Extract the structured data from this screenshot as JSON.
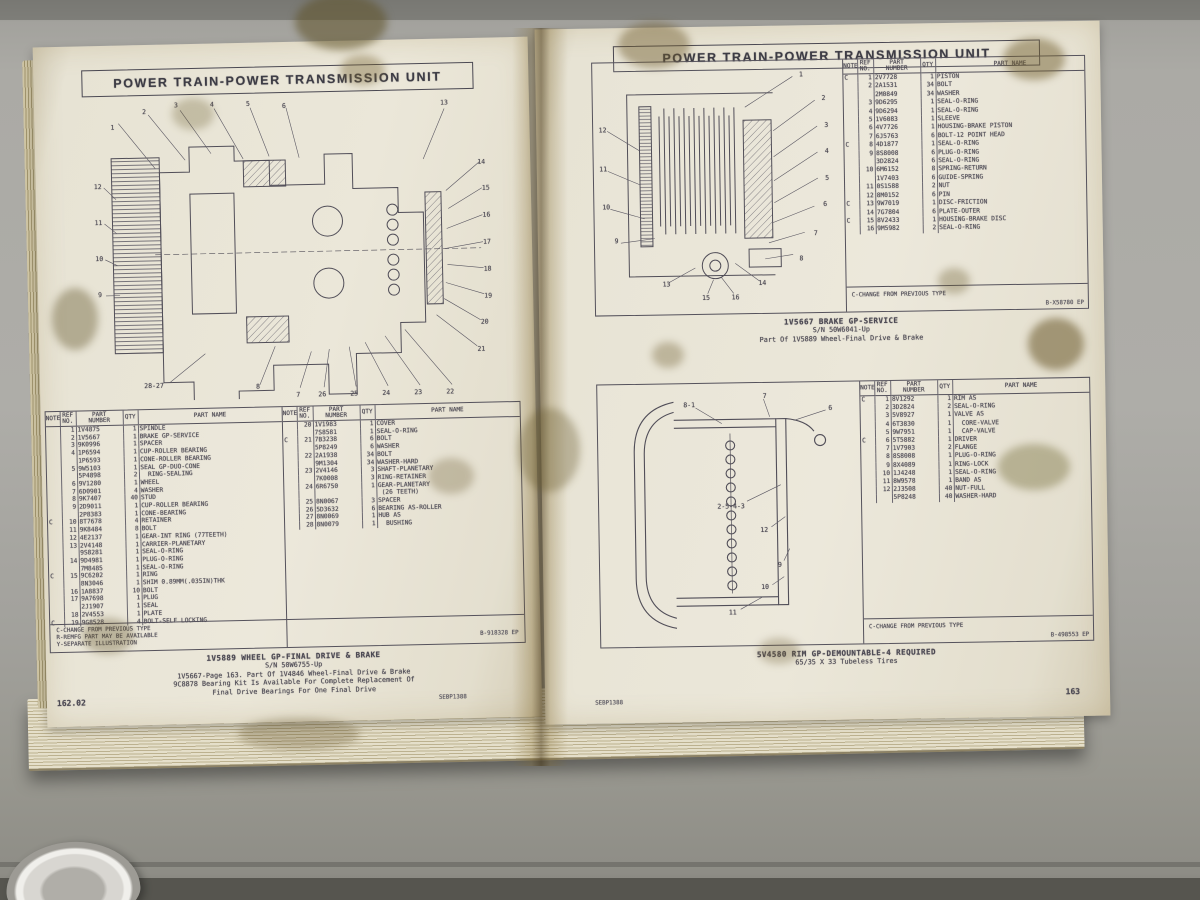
{
  "page_header": "POWER TRAIN-POWER TRANSMISSION UNIT",
  "table_headers": [
    "NOTE",
    "REF\nNO.",
    "PART\nNUMBER",
    "QTY",
    "PART NAME"
  ],
  "left_page": {
    "header": "POWER TRAIN-POWER TRANSMISSION UNIT",
    "parts_left": [
      [
        "",
        "1",
        "1V4875",
        "1",
        "SPINDLE"
      ],
      [
        "",
        "2",
        "1V5667",
        "1",
        "BRAKE GP-SERVICE"
      ],
      [
        "",
        "3",
        "9K0996",
        "1",
        "SPACER"
      ],
      [
        "",
        "4",
        "1P6594",
        "1",
        "CUP-ROLLER BEARING"
      ],
      [
        "",
        "",
        "1P6593",
        "1",
        "CONE-ROLLER BEARING"
      ],
      [
        "",
        "5",
        "9W5103",
        "1",
        "SEAL GP-DUO-CONE"
      ],
      [
        "",
        "",
        "5P4898",
        "2",
        "  RING-SEALING"
      ],
      [
        "",
        "6",
        "9V1280",
        "1",
        "WHEEL"
      ],
      [
        "",
        "7",
        "6D0901",
        "4",
        "WASHER"
      ],
      [
        "",
        "8",
        "9K7407",
        "40",
        "STUD"
      ],
      [
        "",
        "9",
        "2D9011",
        "1",
        "CUP-ROLLER BEARING"
      ],
      [
        "",
        "",
        "2P8383",
        "1",
        "CONE-BEARING"
      ],
      [
        "C",
        "10",
        "8T7678",
        "4",
        "RETAINER"
      ],
      [
        "",
        "11",
        "9K8484",
        "8",
        "BOLT"
      ],
      [
        "",
        "12",
        "4E2137",
        "1",
        "GEAR-INT RING (77TEETH)"
      ],
      [
        "",
        "13",
        "2V4148",
        "1",
        "CARRIER-PLANETARY"
      ],
      [
        "",
        "",
        "9S8281",
        "1",
        "SEAL-O-RING"
      ],
      [
        "",
        "14",
        "9D4981",
        "1",
        "PLUG-O-RING"
      ],
      [
        "",
        "",
        "7M8485",
        "1",
        "SEAL-O-RING"
      ],
      [
        "C",
        "15",
        "9C6202",
        "1",
        "RING"
      ],
      [
        "",
        "",
        "8N3046",
        "1",
        "SHIM 0.89MM(.035IN)THK"
      ],
      [
        "",
        "16",
        "1A8837",
        "10",
        "BOLT"
      ],
      [
        "",
        "17",
        "9A7698",
        "1",
        "PLUG"
      ],
      [
        "",
        "",
        "2J1907",
        "1",
        "SEAL"
      ],
      [
        "",
        "18",
        "2V4553",
        "1",
        "PLATE"
      ],
      [
        "C",
        "19",
        "9G8528",
        "4",
        "BOLT-SELF LOCKING"
      ]
    ],
    "parts_right": [
      [
        "",
        "20",
        "1V1983",
        "1",
        "COVER"
      ],
      [
        "",
        "",
        "7S8581",
        "1",
        "SEAL-O-RING"
      ],
      [
        "C",
        "21",
        "7B3238",
        "6",
        "BOLT"
      ],
      [
        "",
        "",
        "5P8249",
        "6",
        "WASHER"
      ],
      [
        "",
        "22",
        "2A1938",
        "34",
        "BOLT"
      ],
      [
        "",
        "",
        "9M1304",
        "34",
        "WASHER-HARD"
      ],
      [
        "",
        "23",
        "2V4146",
        "3",
        "SHAFT-PLANETARY"
      ],
      [
        "",
        "",
        "7K0008",
        "3",
        "RING-RETAINER"
      ],
      [
        "",
        "24",
        "6R6750",
        "1",
        "GEAR-PLANETARY"
      ],
      [
        "",
        "",
        "",
        "",
        " (26 TEETH)"
      ],
      [
        "",
        "25",
        "8N0067",
        "3",
        "SPACER"
      ],
      [
        "",
        "26",
        "5D3632",
        "6",
        "BEARING AS-ROLLER"
      ],
      [
        "",
        "27",
        "8N0069",
        "1",
        "HUB AS"
      ],
      [
        "",
        "28",
        "8N0079",
        "1",
        "  BUSHING"
      ]
    ],
    "footnotes": "C-CHANGE FROM PREVIOUS TYPE\nR-REMFG PART MAY BE AVAILABLE\nY-SEPARATE ILLUSTRATION",
    "doc_code": "B-918328 EP",
    "caption_title": "1V5889 WHEEL GP-FINAL DRIVE & BRAKE",
    "caption_lines": [
      "S/N 50W6755-Up",
      "1V5667-Page 163. Part Of 1V4846 Wheel-Final Drive & Brake",
      "9C8878 Bearing Kit Is Available For Complete Replacement Of",
      "Final Drive Bearings For One Final Drive"
    ],
    "page_number": "162.02",
    "form_code": "SEBP1388",
    "diagram_callouts": [
      {
        "t": "1",
        "x": 5,
        "y": 8
      },
      {
        "t": "2",
        "x": 13,
        "y": 3
      },
      {
        "t": "3",
        "x": 21,
        "y": 1
      },
      {
        "t": "4",
        "x": 30,
        "y": 1
      },
      {
        "t": "5",
        "x": 39,
        "y": 1
      },
      {
        "t": "6",
        "x": 48,
        "y": 2
      },
      {
        "t": "13",
        "x": 88,
        "y": 2
      },
      {
        "t": "14",
        "x": 97,
        "y": 22
      },
      {
        "t": "15",
        "x": 98,
        "y": 31
      },
      {
        "t": "16",
        "x": 98,
        "y": 40
      },
      {
        "t": "17",
        "x": 98,
        "y": 49
      },
      {
        "t": "18",
        "x": 98,
        "y": 58
      },
      {
        "t": "19",
        "x": 98,
        "y": 67
      },
      {
        "t": "20",
        "x": 97,
        "y": 76
      },
      {
        "t": "21",
        "x": 96,
        "y": 85
      },
      {
        "t": "12",
        "x": 1,
        "y": 28
      },
      {
        "t": "11",
        "x": 1,
        "y": 40
      },
      {
        "t": "10",
        "x": 1,
        "y": 52
      },
      {
        "t": "9",
        "x": 1,
        "y": 64
      },
      {
        "t": "28-27",
        "x": 14,
        "y": 95
      },
      {
        "t": "8",
        "x": 40,
        "y": 96
      },
      {
        "t": "7",
        "x": 50,
        "y": 99
      },
      {
        "t": "26",
        "x": 56,
        "y": 99
      },
      {
        "t": "25",
        "x": 64,
        "y": 99
      },
      {
        "t": "24",
        "x": 72,
        "y": 99
      },
      {
        "t": "23",
        "x": 80,
        "y": 99
      },
      {
        "t": "22",
        "x": 88,
        "y": 99
      }
    ]
  },
  "right_page": {
    "header": "POWER TRAIN-POWER TRANSMISSION UNIT",
    "form_code": "SEBP1388",
    "page_number": "163",
    "brake": {
      "rows": [
        [
          "C",
          "1",
          "2V7728",
          "1",
          "PISTON"
        ],
        [
          "",
          "2",
          "2A1531",
          "34",
          "BOLT"
        ],
        [
          "",
          "",
          "2M0849",
          "34",
          "WASHER"
        ],
        [
          "",
          "3",
          "9D6295",
          "1",
          "SEAL-O-RING"
        ],
        [
          "",
          "4",
          "9D6294",
          "1",
          "SEAL-O-RING"
        ],
        [
          "",
          "5",
          "1V6083",
          "1",
          "SLEEVE"
        ],
        [
          "",
          "6",
          "4V7726",
          "1",
          "HOUSING-BRAKE PISTON"
        ],
        [
          "",
          "7",
          "6J5763",
          "6",
          "BOLT-12 POINT HEAD"
        ],
        [
          "C",
          "8",
          "4D1877",
          "1",
          "SEAL-O-RING"
        ],
        [
          "",
          "9",
          "8S8008",
          "6",
          "PLUG-O-RING"
        ],
        [
          "",
          "",
          "3D2824",
          "6",
          "SEAL-O-RING"
        ],
        [
          "",
          "10",
          "6M6152",
          "8",
          "SPRING-RETURN"
        ],
        [
          "",
          "",
          "1V7403",
          "6",
          "GUIDE-SPRING"
        ],
        [
          "",
          "11",
          "0S1588",
          "2",
          "NUT"
        ],
        [
          "",
          "12",
          "8M0152",
          "6",
          "PIN"
        ],
        [
          "C",
          "13",
          "9W7019",
          "1",
          "DISC-FRICTION"
        ],
        [
          "",
          "14",
          "7G7804",
          "6",
          "PLATE-OUTER"
        ],
        [
          "C",
          "15",
          "8V2433",
          "1",
          "HOUSING-BRAKE DISC"
        ],
        [
          "",
          "16",
          "9M5982",
          "2",
          "SEAL-O-RING"
        ]
      ],
      "footnote": "C-CHANGE FROM PREVIOUS TYPE",
      "doc_code": "B-X58780 EP",
      "caption_title": "1V5667 BRAKE GP-SERVICE",
      "caption_lines": [
        "S/N 50W6041-Up",
        "Part Of 1V5889 Wheel-Final Drive & Brake"
      ],
      "callouts": [
        {
          "t": "1",
          "x": 84,
          "y": 4
        },
        {
          "t": "2",
          "x": 93,
          "y": 14
        },
        {
          "t": "3",
          "x": 94,
          "y": 25
        },
        {
          "t": "4",
          "x": 94,
          "y": 36
        },
        {
          "t": "5",
          "x": 94,
          "y": 47
        },
        {
          "t": "6",
          "x": 93,
          "y": 58
        },
        {
          "t": "7",
          "x": 89,
          "y": 70
        },
        {
          "t": "8",
          "x": 83,
          "y": 80
        },
        {
          "t": "12",
          "x": 3,
          "y": 26
        },
        {
          "t": "11",
          "x": 3,
          "y": 42
        },
        {
          "t": "10",
          "x": 4,
          "y": 58
        },
        {
          "t": "9",
          "x": 8,
          "y": 72
        },
        {
          "t": "13",
          "x": 28,
          "y": 90
        },
        {
          "t": "15",
          "x": 44,
          "y": 96
        },
        {
          "t": "16",
          "x": 56,
          "y": 96
        },
        {
          "t": "14",
          "x": 67,
          "y": 90
        }
      ]
    },
    "rim": {
      "rows": [
        [
          "C",
          "1",
          "8V1292",
          "1",
          "RIM AS"
        ],
        [
          "",
          "2",
          "3D2824",
          "2",
          "SEAL-O-RING"
        ],
        [
          "",
          "3",
          "5V8927",
          "1",
          "VALVE AS"
        ],
        [
          "",
          "4",
          "6T3830",
          "1",
          "  CORE-VALVE"
        ],
        [
          "",
          "5",
          "9W7951",
          "1",
          "  CAP-VALVE"
        ],
        [
          "C",
          "6",
          "5T5882",
          "1",
          "DRIVER"
        ],
        [
          "",
          "7",
          "1V7903",
          "2",
          "FLANGE"
        ],
        [
          "",
          "8",
          "8S8008",
          "1",
          "PLUG-O-RING"
        ],
        [
          "",
          "9",
          "8X4089",
          "1",
          "RING-LOCK"
        ],
        [
          "",
          "10",
          "1J4248",
          "1",
          "SEAL-O-RING"
        ],
        [
          "",
          "11",
          "8W9578",
          "1",
          "BAND AS"
        ],
        [
          "",
          "12",
          "2J3508",
          "40",
          "NUT-FULL"
        ],
        [
          "",
          "",
          "5P8248",
          "40",
          "WASHER-HARD"
        ]
      ],
      "footnote": "C-CHANGE FROM PREVIOUS TYPE",
      "doc_code": "B-498553 EP",
      "caption_title": "5V4580 RIM GP-DEMOUNTABLE-4 REQUIRED",
      "caption_lines": [
        "65/35 X 33 Tubeless Tires"
      ],
      "callouts": [
        {
          "t": "8-1",
          "x": 34,
          "y": 6
        },
        {
          "t": "7",
          "x": 64,
          "y": 3
        },
        {
          "t": "6",
          "x": 90,
          "y": 8
        },
        {
          "t": "2-5-4-3",
          "x": 50,
          "y": 47
        },
        {
          "t": "12",
          "x": 63,
          "y": 57
        },
        {
          "t": "9",
          "x": 69,
          "y": 71
        },
        {
          "t": "10",
          "x": 63,
          "y": 80
        },
        {
          "t": "11",
          "x": 50,
          "y": 90
        }
      ]
    }
  }
}
